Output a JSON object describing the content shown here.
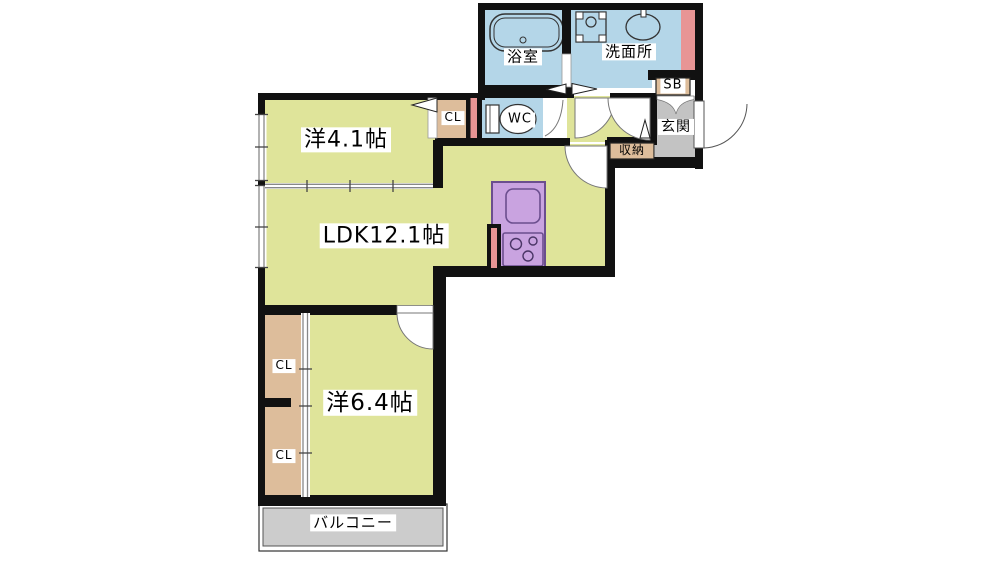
{
  "rooms": {
    "bathroom": {
      "label": "浴室"
    },
    "washroom": {
      "label": "洗面所"
    },
    "toilet": {
      "label": "WC"
    },
    "closet_bedroom1": {
      "label": "CL"
    },
    "shoe_box": {
      "label": "SB"
    },
    "entrance": {
      "label": "玄関"
    },
    "hall_storage": {
      "label": "収納"
    },
    "bedroom1": {
      "label": "洋4.1帖"
    },
    "ldk": {
      "label": "LDK12.1帖"
    },
    "bedroom2": {
      "label": "洋6.4帖"
    },
    "closet_bedroom2_upper": {
      "label": "CL"
    },
    "closet_bedroom2_lower": {
      "label": "CL"
    },
    "balcony": {
      "label": "バルコニー"
    }
  },
  "colors": {
    "wall": "#111111",
    "room_yellow": "#dfe49a",
    "wet_blue": "#b4d6e8",
    "closet_tan": "#ddbd9b",
    "accent_pink": "#e89595",
    "kitchen_purple": "#c9a3e0",
    "kitchen_outline": "#6b4e8e",
    "entry_gray": "#c3c3c3",
    "balcony_gray": "#cccccc",
    "background": "#ffffff"
  }
}
